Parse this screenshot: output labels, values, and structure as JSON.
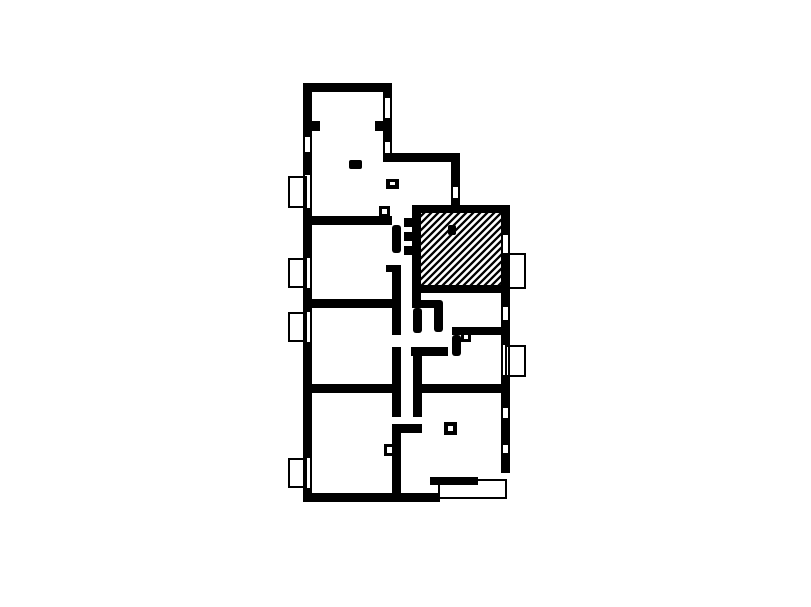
{
  "canvas": {
    "width": 811,
    "height": 607,
    "background_color": "#ffffff",
    "wall_color": "#000000",
    "hatch_color": "#000000"
  },
  "floor_plan": {
    "description": "apartment-floor-plan",
    "hatched_room": {
      "rect": [
        421,
        213,
        80,
        72
      ],
      "pattern": "diagonal-lines",
      "spacing": 7,
      "stroke_width": 2.3
    },
    "walls": [
      [
        303,
        83,
        89,
        9
      ],
      [
        303,
        92,
        9,
        45
      ],
      [
        303,
        152,
        9,
        23
      ],
      [
        303,
        208,
        9,
        50
      ],
      [
        303,
        288,
        9,
        24
      ],
      [
        303,
        342,
        9,
        116
      ],
      [
        303,
        488,
        9,
        14
      ],
      [
        383,
        92,
        9,
        6
      ],
      [
        383,
        118,
        9,
        24
      ],
      [
        312,
        121,
        8,
        10
      ],
      [
        375,
        121,
        8,
        10
      ],
      [
        383,
        153,
        77,
        9
      ],
      [
        451,
        162,
        9,
        25
      ],
      [
        451,
        198,
        9,
        7
      ],
      [
        412,
        205,
        98,
        8
      ],
      [
        412,
        213,
        9,
        95
      ],
      [
        404,
        218,
        8,
        9
      ],
      [
        404,
        232,
        8,
        9
      ],
      [
        404,
        246,
        8,
        9
      ],
      [
        501,
        213,
        9,
        22
      ],
      [
        501,
        253,
        9,
        54
      ],
      [
        412,
        285,
        89,
        8
      ],
      [
        412,
        300,
        28,
        8
      ],
      [
        501,
        320,
        9,
        25
      ],
      [
        501,
        375,
        9,
        33
      ],
      [
        501,
        418,
        9,
        27
      ],
      [
        501,
        453,
        9,
        20
      ],
      [
        312,
        216,
        80,
        9
      ],
      [
        312,
        299,
        80,
        9
      ],
      [
        312,
        384,
        80,
        9
      ],
      [
        422,
        384,
        79,
        9
      ],
      [
        452,
        327,
        58,
        8
      ],
      [
        411,
        347,
        37,
        9
      ],
      [
        392,
        424,
        30,
        9
      ],
      [
        392,
        433,
        9,
        69
      ],
      [
        303,
        493,
        137,
        9
      ],
      [
        430,
        477,
        48,
        8
      ],
      [
        392,
        265,
        9,
        70
      ],
      [
        386,
        265,
        6,
        7
      ],
      [
        392,
        347,
        9,
        70
      ],
      [
        413,
        347,
        9,
        70
      ]
    ],
    "wall_stubs_rounded": [
      [
        392,
        225,
        9,
        28
      ],
      [
        413,
        308,
        9,
        25
      ],
      [
        434,
        300,
        9,
        32
      ],
      [
        452,
        335,
        9,
        21
      ]
    ],
    "windows": [
      {
        "rect": [
          303,
          137,
          9,
          15
        ]
      },
      {
        "rect": [
          383,
          98,
          9,
          20
        ]
      },
      {
        "rect": [
          383,
          142,
          9,
          11
        ]
      },
      {
        "rect": [
          451,
          187,
          9,
          11
        ]
      },
      {
        "rect": [
          303,
          175,
          9,
          33
        ]
      },
      {
        "rect": [
          303,
          258,
          9,
          30
        ]
      },
      {
        "rect": [
          303,
          312,
          9,
          30
        ]
      },
      {
        "rect": [
          303,
          458,
          9,
          30
        ]
      },
      {
        "rect": [
          501,
          235,
          9,
          18
        ]
      },
      {
        "rect": [
          501,
          307,
          9,
          13
        ]
      },
      {
        "rect": [
          501,
          345,
          9,
          30
        ]
      },
      {
        "rect": [
          501,
          408,
          9,
          10
        ]
      },
      {
        "rect": [
          501,
          445,
          9,
          8
        ]
      }
    ],
    "sill_boxes": [
      [
        288,
        176,
        19,
        32
      ],
      [
        288,
        258,
        19,
        30
      ],
      [
        288,
        312,
        19,
        30
      ],
      [
        288,
        458,
        19,
        30
      ],
      [
        505,
        253,
        21,
        36
      ],
      [
        505,
        345,
        21,
        32
      ]
    ],
    "porch": {
      "rect": [
        438,
        479,
        69,
        20
      ]
    },
    "hollow_symbols": [
      {
        "outer": [
          379,
          206,
          11,
          11
        ],
        "inner": [
          382,
          209,
          5,
          5
        ]
      },
      {
        "outer": [
          444,
          422,
          13,
          13
        ],
        "inner": [
          448,
          426,
          5,
          5
        ]
      },
      {
        "outer": [
          461,
          332,
          10,
          10
        ],
        "inner": [
          464,
          335,
          4,
          4
        ]
      },
      {
        "outer": [
          384,
          444,
          11,
          12
        ],
        "inner": [
          387,
          447,
          5,
          6
        ]
      },
      {
        "outer": [
          386,
          179,
          13,
          10
        ],
        "inner": [
          390,
          182,
          5,
          3
        ]
      }
    ],
    "solid_marks": [
      [
        349,
        160,
        13,
        9
      ],
      [
        448,
        225,
        8,
        10
      ]
    ]
  }
}
